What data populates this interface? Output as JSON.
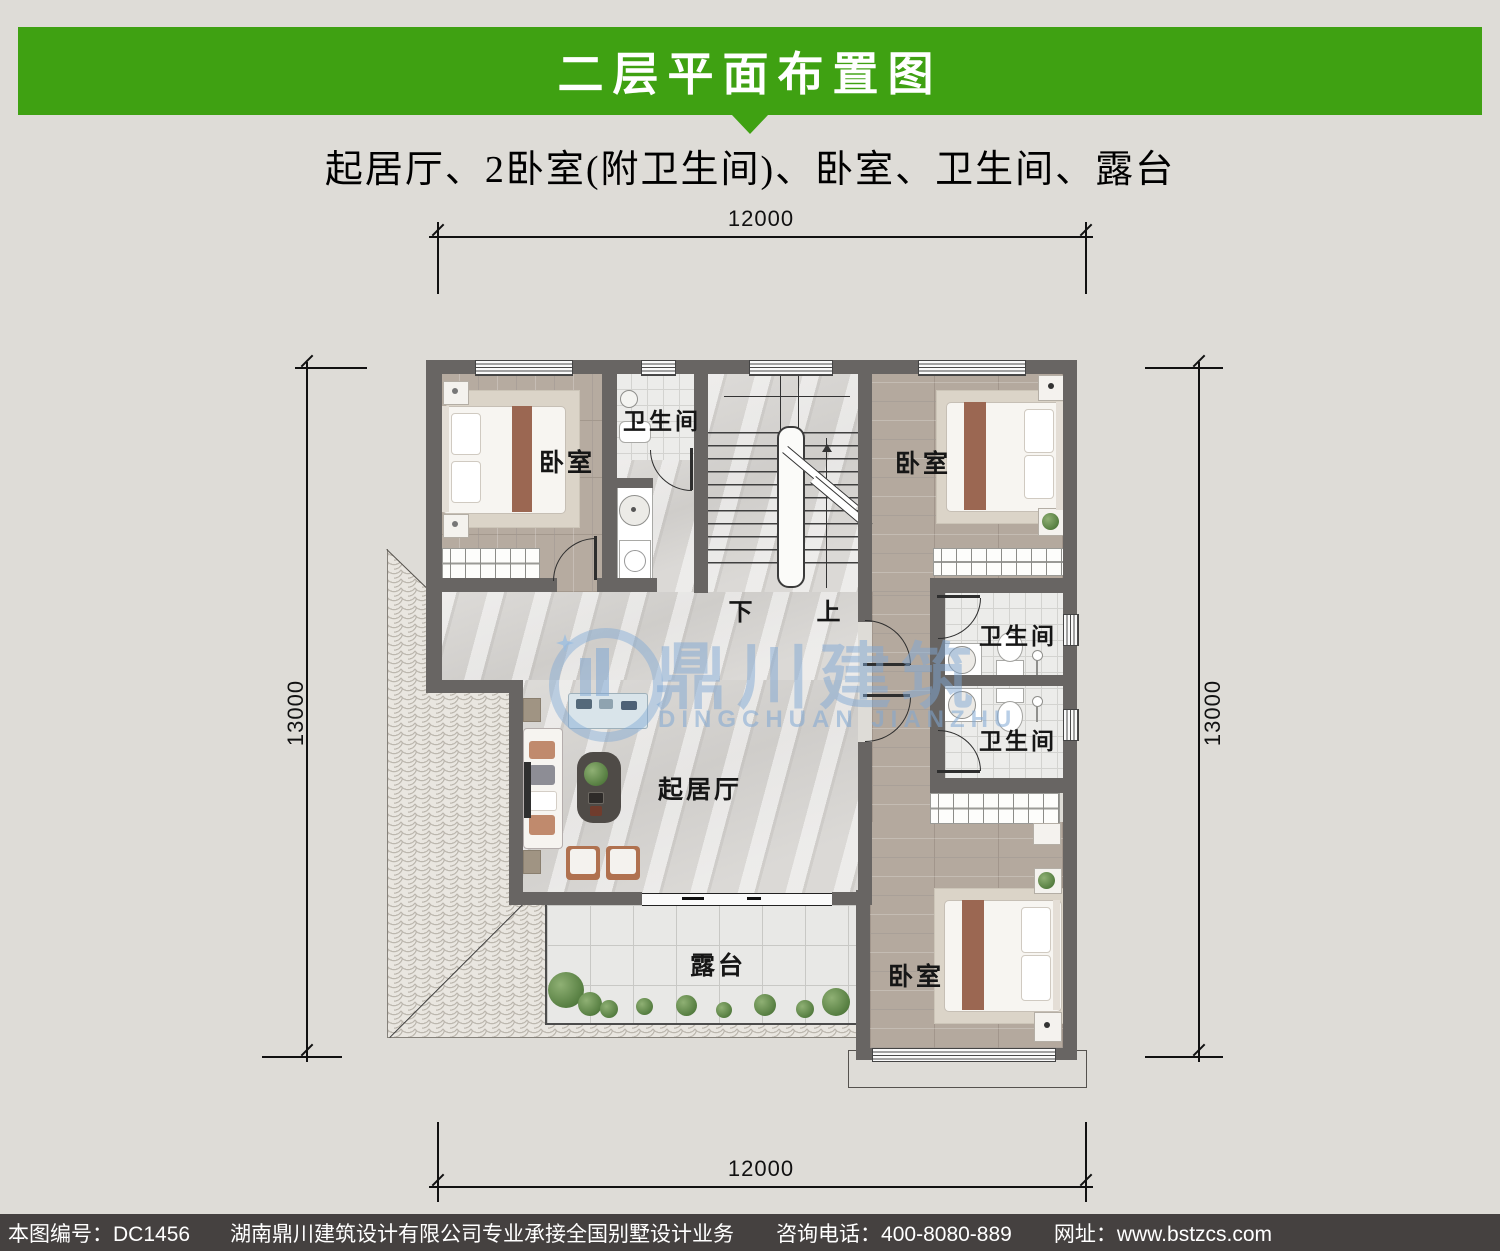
{
  "header": {
    "title": "二层平面布置图"
  },
  "subtitle": "起居厅、2卧室(附卫生间)、卧室、卫生间、露台",
  "dimensions": {
    "top": "12000",
    "bottom": "12000",
    "left": "13000",
    "right": "13000"
  },
  "plan": {
    "labels": {
      "bedroom_top_left": "卧室",
      "bedroom_top_right": "卧室",
      "bedroom_bottom_right": "卧室",
      "bath_top": "卫生间",
      "bath_right_upper": "卫生间",
      "bath_right_lower": "卫生间",
      "living": "起居厅",
      "terrace": "露台",
      "stair_down": "下",
      "stair_up": "上"
    }
  },
  "watermark": {
    "cn": "鼎川建筑",
    "en": "DINGCHUAN JIANZHU"
  },
  "footer": {
    "plan_no": "本图编号：DC1456",
    "company": "湖南鼎川建筑设计有限公司专业承接全国别墅设计业务",
    "phone": "咨询电话：400-8080-889",
    "website": "网址：www.bstzcs.com"
  },
  "colors": {
    "accent_green": "#3fa112",
    "wall_gray": "#686563",
    "watermark_blue": "#7fa8d4",
    "footer_bg": "#454140"
  }
}
